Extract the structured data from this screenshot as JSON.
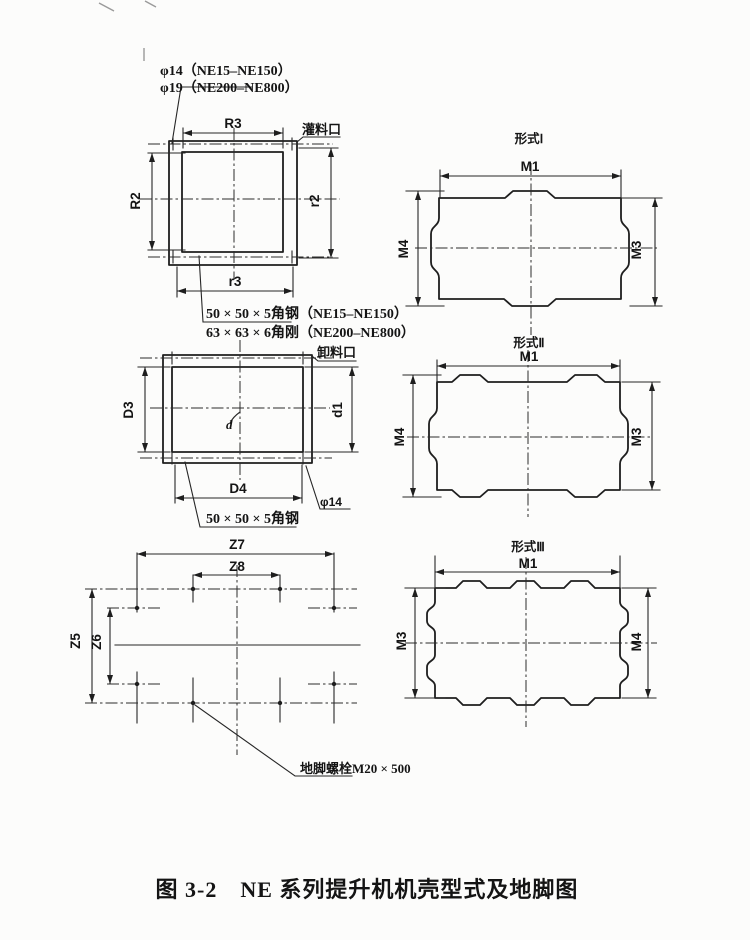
{
  "caption": "图 3-2　NE 系列提升机机壳型式及地脚图",
  "filling_port_view": {
    "bolt_hole_note_line1": "φ14（NE15–NE150）",
    "bolt_hole_note_line2": "φ19（NE200–NE800）",
    "port_label": "灌料口",
    "dim_top": "R3",
    "dim_left": "R2",
    "dim_right": "r2",
    "dim_bottom": "r3",
    "angle_steel_note_line1": "50 × 50 × 5角钢（NE15–NE150）",
    "angle_steel_note_line2": "63 × 63 × 6角刚（NE200–NE800）"
  },
  "discharge_port_view": {
    "port_label": "卸料口",
    "dim_left": "D3",
    "dim_right": "d1",
    "dim_bottom": "D4",
    "bolt_hole_label": "φ14",
    "center_mark": "d",
    "angle_steel_note": "50 × 50 × 5角钢"
  },
  "foundation_plan": {
    "dim_top_outer": "Z7",
    "dim_top_inner": "Z8",
    "dim_left_outer": "Z5",
    "dim_left_inner": "Z6",
    "anchor_bolt_note": "地脚螺栓M20 × 500"
  },
  "housing_types": [
    {
      "title": "形式Ⅰ",
      "dim_top": "M1",
      "dim_left": "M4",
      "dim_right": "M3"
    },
    {
      "title": "形式Ⅱ",
      "dim_top": "M1",
      "dim_left": "M4",
      "dim_right": "M3"
    },
    {
      "title": "形式Ⅲ",
      "dim_top": "M1",
      "dim_left": "M3",
      "dim_right": "M4"
    }
  ]
}
